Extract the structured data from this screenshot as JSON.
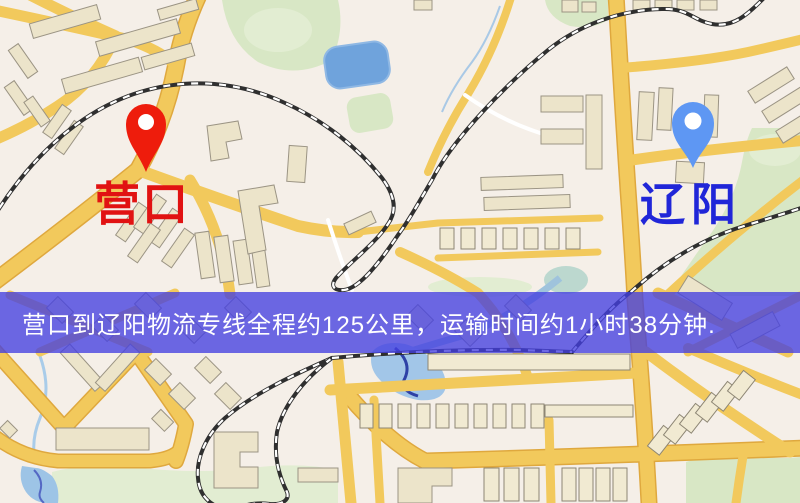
{
  "map": {
    "origin": {
      "label": "营口",
      "pin_color": "#ee1c0c",
      "label_color": "#e11212"
    },
    "destination": {
      "label": "辽阳",
      "pin_color": "#5e97f3",
      "label_color": "#2026d8"
    },
    "banner": {
      "text": "营口到辽阳物流专线全程约125公里，运输时间约1小时38分钟.",
      "distance_text": "125公里",
      "duration_text": "1小时38分钟",
      "background": "rgba(68,63,224,0.78)",
      "text_color": "#ffffff"
    },
    "colors": {
      "background": "#f5efe8",
      "road": "#f2c95c",
      "road_casing": "#dfa83e",
      "building": "#ece4ca",
      "park": "#d8e7c5",
      "water": "#a2c6e8",
      "lake": "#6fa3dc",
      "railway": "#2f2f2f"
    }
  }
}
